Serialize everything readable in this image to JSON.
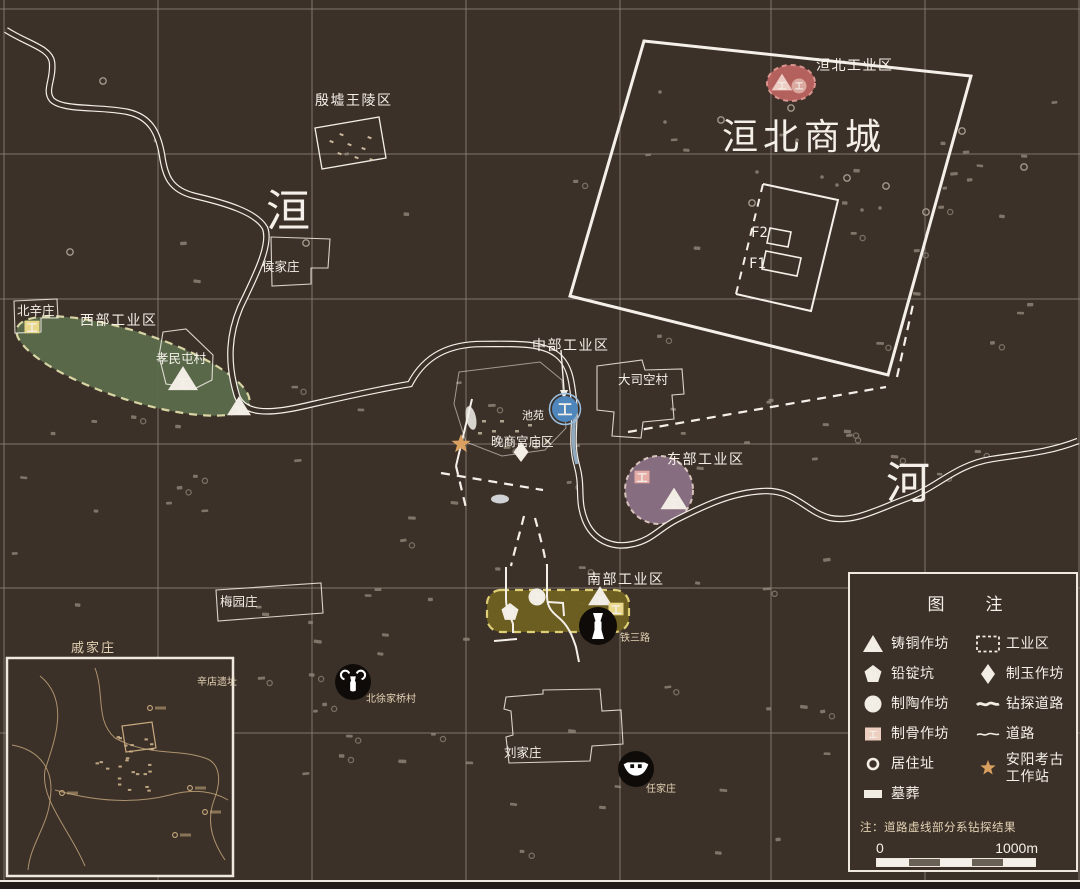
{
  "colors": {
    "background": "#3c3129",
    "frame": "#efe9df",
    "grid": "#8f867c",
    "line_white": "#f4f0e9",
    "tan_text": "#e3d3b4",
    "scatter": "#94897b",
    "bottom_strip": "#241c16",
    "zone_west_fill": "#5d6d4d",
    "zone_west_border": "#e6e2ae",
    "zone_east_fill": "#8b7285",
    "zone_east_border": "#e0cbc4",
    "zone_huanbei_fill": "#bb6360",
    "zone_huanbei_border": "#e39a94",
    "zone_south_fill": "#6f6020",
    "zone_south_border": "#e7d77b",
    "pottery_blue": "#4f86bb",
    "icon_yellow": "#e9d78a",
    "icon_pink": "#e4aca4",
    "icon_pale_pink": "#edccc4",
    "star": "#d9a05f",
    "black_circle": "#0e0b08",
    "pond_blue": "#9fc0dd"
  },
  "labels": [
    {
      "name": "huanbei-industrial-zone-label",
      "text": "洹北工业区",
      "x": 816,
      "y": 70,
      "cls": "z"
    },
    {
      "name": "huanbei-city-label",
      "text": "洹北商城",
      "x": 722,
      "y": 149,
      "cls": "xl"
    },
    {
      "name": "royal-tombs-label",
      "text": "殷墟王陵区",
      "x": 315,
      "y": 105,
      "cls": "z"
    },
    {
      "name": "river-char-huan",
      "text": "洹",
      "x": 266,
      "y": 226,
      "cls": "riv"
    },
    {
      "name": "river-char-he",
      "text": "河",
      "x": 886,
      "y": 498,
      "cls": "riv"
    },
    {
      "name": "houjiazhuang-label",
      "text": "侯家庄",
      "x": 262,
      "y": 271,
      "cls": "v"
    },
    {
      "name": "beixinzhuang-label",
      "text": "北辛庄",
      "x": 17,
      "y": 315,
      "cls": "v"
    },
    {
      "name": "west-zone-label",
      "text": "西部工业区",
      "x": 80,
      "y": 325,
      "cls": "z"
    },
    {
      "name": "xiaomintun-label",
      "text": "孝民屯村",
      "x": 156,
      "y": 363,
      "cls": "v"
    },
    {
      "name": "central-zone-label",
      "text": "中部工业区",
      "x": 532,
      "y": 350,
      "cls": "z"
    },
    {
      "name": "dasikong-label",
      "text": "大司空村",
      "x": 618,
      "y": 384,
      "cls": "v"
    },
    {
      "name": "pond-garden-label",
      "text": "池苑",
      "x": 522,
      "y": 419,
      "cls": "s"
    },
    {
      "name": "palace-temple-label",
      "text": "晚商宫庙区",
      "x": 491,
      "y": 446,
      "cls": "v"
    },
    {
      "name": "east-zone-label",
      "text": "东部工业区",
      "x": 667,
      "y": 464,
      "cls": "z"
    },
    {
      "name": "south-zone-label",
      "text": "南部工业区",
      "x": 587,
      "y": 584,
      "cls": "z"
    },
    {
      "name": "tiesan-road-label",
      "text": "铁三路",
      "x": 620,
      "y": 641,
      "cls": "t"
    },
    {
      "name": "meiyuanzhuang-label",
      "text": "梅园庄",
      "x": 220,
      "y": 606,
      "cls": "v"
    },
    {
      "name": "qijiazhuang-label",
      "text": "戚家庄",
      "x": 71,
      "y": 652,
      "cls": "t2"
    },
    {
      "name": "beixujiaqiao-label",
      "text": "北徐家桥村",
      "x": 366,
      "y": 702,
      "cls": "t"
    },
    {
      "name": "liujiazhuang-label",
      "text": "刘家庄",
      "x": 504,
      "y": 757,
      "cls": "v"
    },
    {
      "name": "renjiazhuang-label",
      "text": "任家庄",
      "x": 646,
      "y": 792,
      "cls": "t"
    },
    {
      "name": "xindian-site-label",
      "text": "辛店遗址",
      "x": 197,
      "y": 685,
      "cls": "t"
    },
    {
      "name": "f2-label",
      "text": "F2",
      "x": 751,
      "y": 237,
      "cls": "f"
    },
    {
      "name": "f1-label",
      "text": "F1",
      "x": 749,
      "y": 268,
      "cls": "f"
    }
  ],
  "zones": {
    "west": {
      "type": "ellipse",
      "cx": 133,
      "cy": 366,
      "rx": 122,
      "ry": 34,
      "rot": 18
    },
    "east": {
      "type": "circle",
      "cx": 659,
      "cy": 490,
      "r": 34
    },
    "huanbei": {
      "type": "ellipse",
      "cx": 791,
      "cy": 83,
      "rx": 24,
      "ry": 18,
      "rot": 0
    },
    "south": {
      "type": "rect",
      "x": 487,
      "y": 590,
      "w": 142,
      "h": 42,
      "r": 14
    }
  },
  "markers": [
    {
      "name": "bronze-workshop-marker",
      "type": "triangle",
      "x": 183,
      "y": 381,
      "w": 30,
      "fill": "#f2ede4",
      "glyph": "工"
    },
    {
      "name": "bronze-workshop-marker",
      "type": "triangle",
      "x": 239,
      "y": 408,
      "w": 24,
      "fill": "#f2ede4",
      "glyph": "工"
    },
    {
      "name": "bronze-workshop-marker",
      "type": "triangle",
      "x": 674,
      "y": 501,
      "w": 27,
      "fill": "#f2ede4",
      "glyph": "工"
    },
    {
      "name": "bronze-workshop-marker",
      "type": "triangle",
      "x": 600,
      "y": 598,
      "w": 24,
      "fill": "#f2ede4",
      "glyph": "工"
    },
    {
      "name": "bronze-workshop-marker",
      "type": "triangle",
      "x": 782,
      "y": 84,
      "w": 21,
      "fill": "#edccc4",
      "glyph": "工"
    },
    {
      "name": "pottery-workshop-marker",
      "type": "circle",
      "x": 799,
      "y": 86,
      "r": 7.5,
      "fill": "#dba8a0",
      "glyph": "工"
    },
    {
      "name": "pottery-workshop-marker",
      "type": "circle",
      "x": 565,
      "y": 409,
      "r": 13,
      "fill": "#4f86bb",
      "glyph": "工",
      "ring": "#9cc0e0"
    },
    {
      "name": "pottery-workshop-marker",
      "type": "circle",
      "x": 537,
      "y": 597,
      "r": 8.5,
      "fill": "#f2ede4",
      "glyph": "工"
    },
    {
      "name": "lead-ingot-pit-marker",
      "type": "pent",
      "x": 510,
      "y": 612,
      "r": 9,
      "fill": "#f2ede4",
      "glyph": "铅"
    },
    {
      "name": "bone-workshop-marker",
      "type": "square",
      "x": 32,
      "y": 327,
      "w": 15,
      "fill": "#e9d78a",
      "glyph": "工"
    },
    {
      "name": "bone-workshop-marker",
      "type": "square",
      "x": 616,
      "y": 609,
      "w": 15,
      "fill": "#e9d78a",
      "glyph": "工"
    },
    {
      "name": "bone-workshop-marker",
      "type": "square",
      "x": 642,
      "y": 477,
      "w": 15,
      "fill": "#e4aca4",
      "glyph": "工"
    },
    {
      "name": "jade-workshop-marker",
      "type": "diamond",
      "x": 521,
      "y": 452,
      "r": 10,
      "fill": "#f2ede4",
      "glyph": "玉"
    },
    {
      "name": "anyang-station-marker",
      "type": "star",
      "x": 461,
      "y": 444,
      "r": 10,
      "fill": "#d9a05f"
    }
  ],
  "artifacts": [
    {
      "name": "bronze-gu-icon",
      "x": 598,
      "y": 626,
      "r": 19,
      "glyph": "gu"
    },
    {
      "name": "horned-vessel-icon",
      "x": 353,
      "y": 682,
      "r": 18,
      "glyph": "horn"
    },
    {
      "name": "boat-vessel-icon",
      "x": 636,
      "y": 769,
      "r": 18,
      "glyph": "boat"
    },
    {
      "name": "bird-statue-icon",
      "x": 178,
      "y": 681,
      "r": 16,
      "glyph": "bird"
    }
  ],
  "legend": {
    "title": "图　注",
    "left": [
      {
        "icon": "bronze",
        "glyph": "工",
        "label": "铸铜作坊"
      },
      {
        "icon": "lead",
        "glyph": "铅",
        "label": "铅锭坑"
      },
      {
        "icon": "pottery",
        "glyph": "工",
        "label": "制陶作坊"
      },
      {
        "icon": "bone",
        "glyph": "工",
        "label": "制骨作坊"
      },
      {
        "icon": "residence",
        "glyph": "",
        "label": "居住址"
      },
      {
        "icon": "tomb",
        "glyph": "",
        "label": "墓葬"
      }
    ],
    "right": [
      {
        "icon": "zone",
        "glyph": "",
        "label": "工业区"
      },
      {
        "icon": "jade",
        "glyph": "玉",
        "label": "制玉作坊"
      },
      {
        "icon": "drill",
        "glyph": "",
        "label": "钻探道路"
      },
      {
        "icon": "road",
        "glyph": "",
        "label": "道路"
      },
      {
        "icon": "station",
        "glyph": "",
        "label": "安阳考古工作站"
      }
    ],
    "note": "注：道路虚线部分系钻探结果",
    "scale_start": "0",
    "scale_end": "1000m"
  }
}
